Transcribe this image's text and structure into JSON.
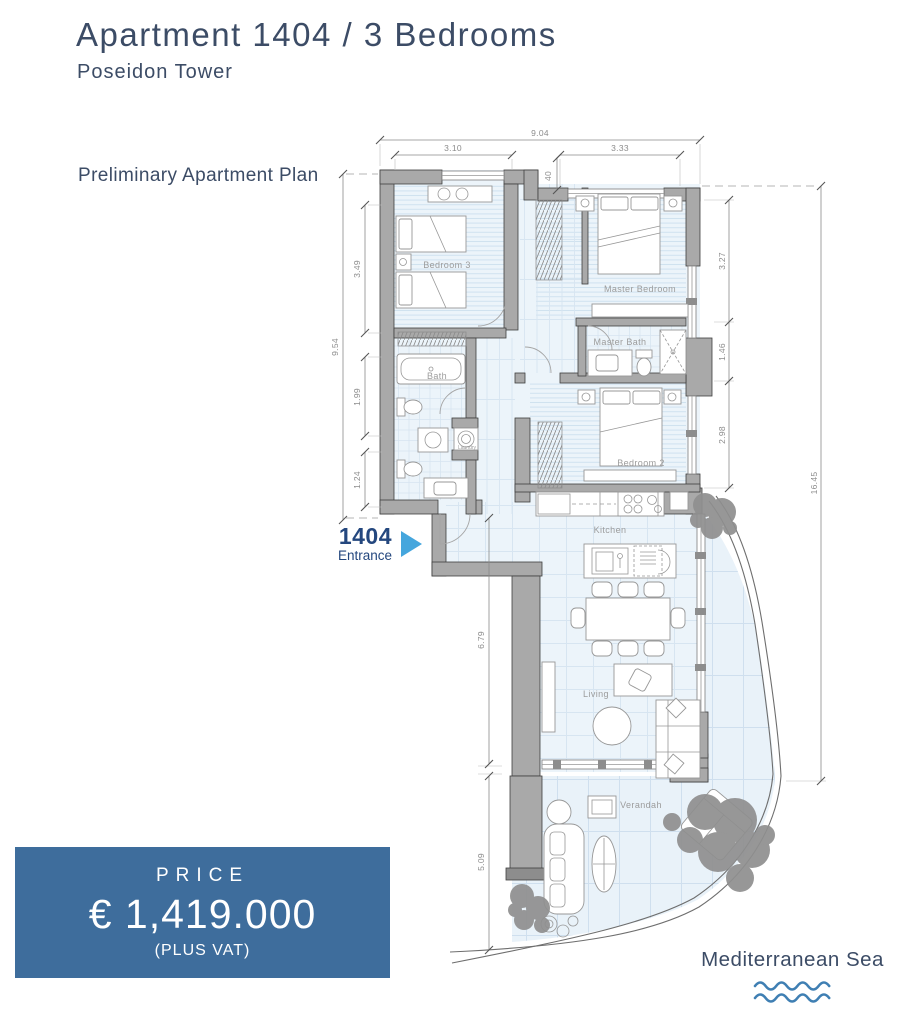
{
  "page": {
    "title": "Apartment 1404 / 3 Bedrooms",
    "subtitle": "Poseidon Tower",
    "plan_caption": "Preliminary Apartment Plan"
  },
  "entrance": {
    "number": "1404",
    "label": "Entrance"
  },
  "price": {
    "heading": "PRICE",
    "amount": "€ 1,419.000",
    "note": "(PLUS VAT)"
  },
  "sea": {
    "label": "Mediterranean Sea"
  },
  "rooms": {
    "bedroom3": "Bedroom 3",
    "master_bedroom": "Master Bedroom",
    "master_bath": "Master Bath",
    "bath": "Bath",
    "laundry": "Laundry",
    "bedroom2": "Bedroom 2",
    "kitchen": "Kitchen",
    "living": "Living",
    "verandah": "Verandah"
  },
  "dimensions": {
    "top_total": "9.04",
    "top_left": "3.10",
    "top_right": "3.33",
    "top_step": "40",
    "left_total": "9.54",
    "left_a": "3.49",
    "left_b": "1.99",
    "left_c": "1.24",
    "right_a": "3.27",
    "right_b": "1.46",
    "right_c": "2.98",
    "right_total": "16.45",
    "lower_a": "6.79",
    "lower_b": "5.09"
  },
  "colors": {
    "accent": "#3E6D9C",
    "heading": "#3C4C66",
    "entrance": "#24477E",
    "arrow": "#45A6DD",
    "wave": "#3F7FB3",
    "wall": "#A9A9A9",
    "floor": "#ECF4FA"
  }
}
